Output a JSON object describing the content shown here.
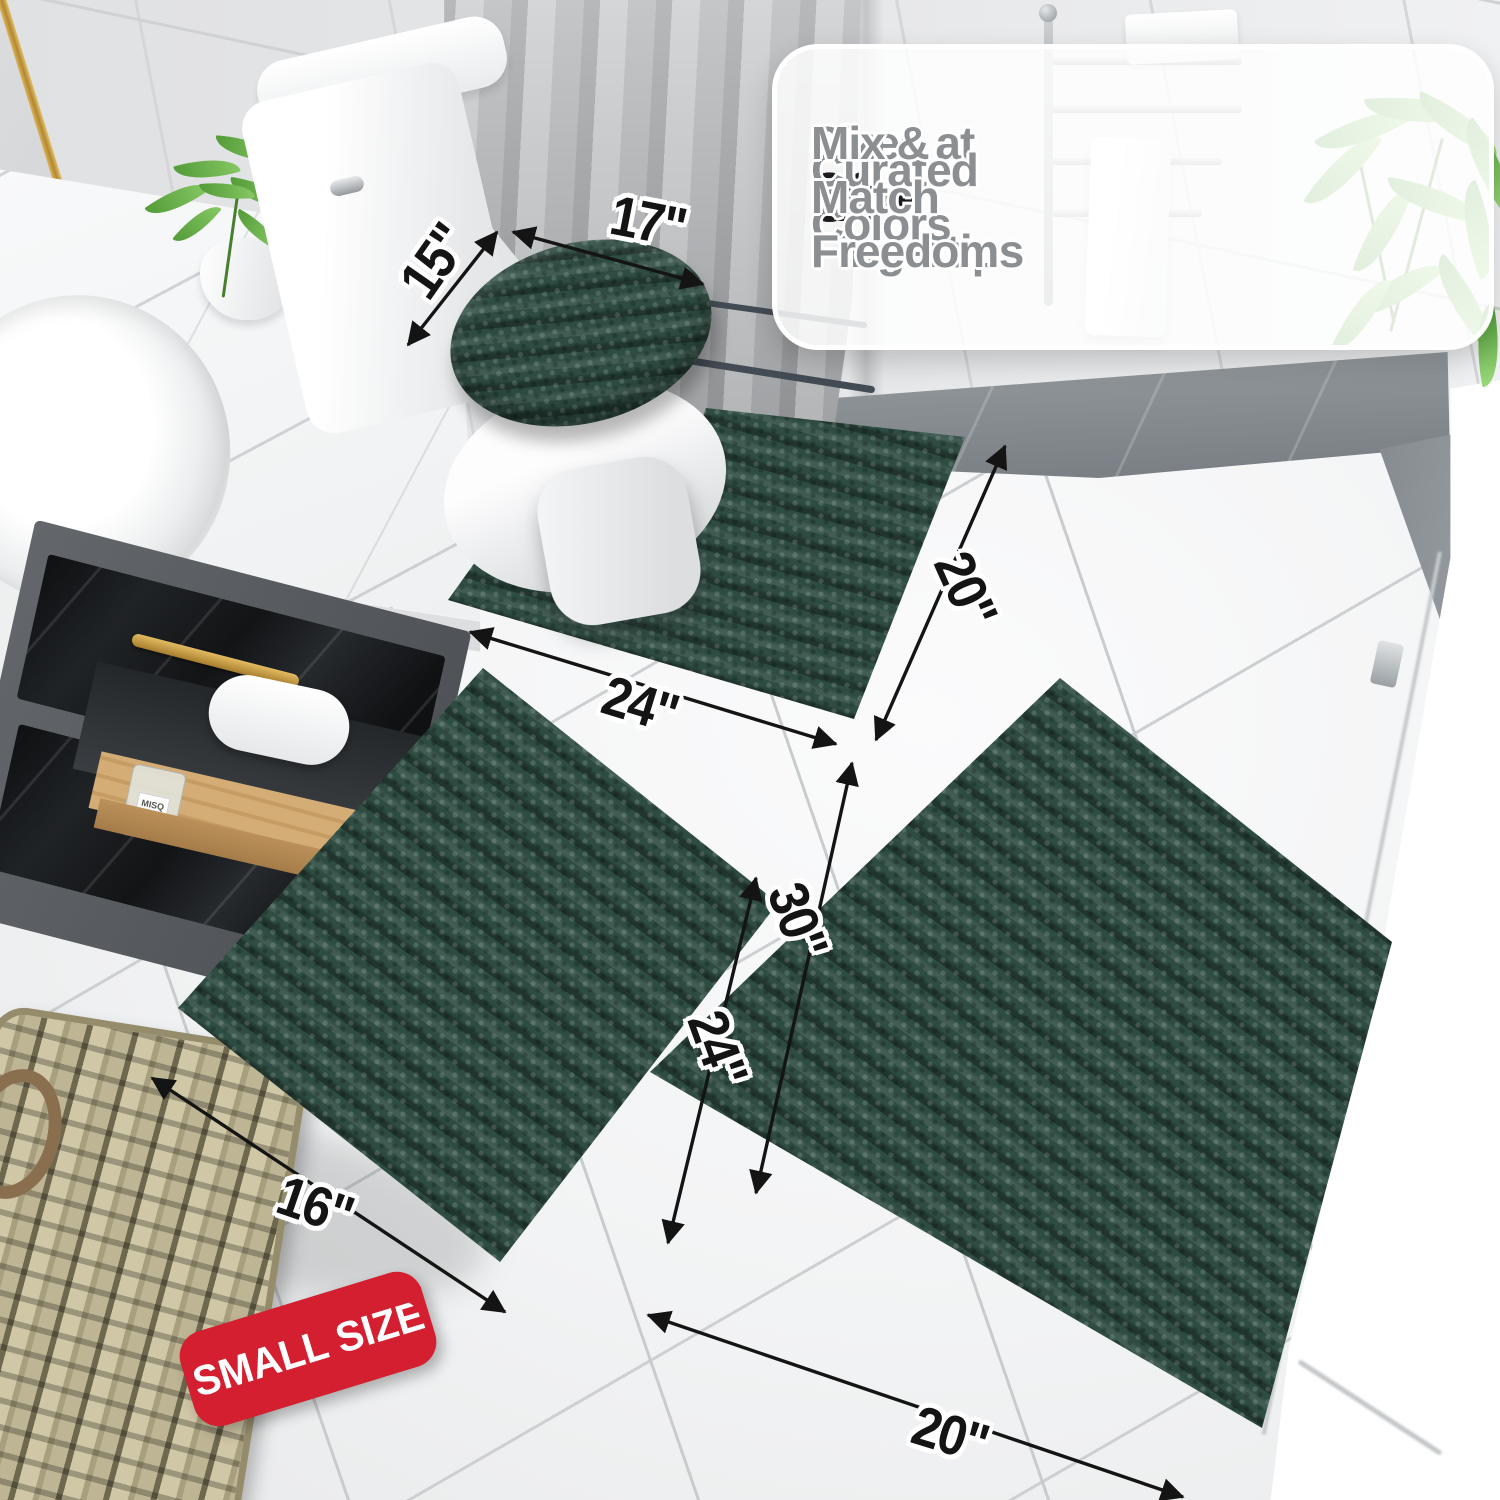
{
  "callout": {
    "items": [
      {
        "icon": "check",
        "stat": "20+",
        "text": "Sizes at Your Fingertips"
      },
      {
        "icon": "check",
        "stat": "30+",
        "text": "Curated Colors"
      },
      {
        "icon": "check",
        "stat": "",
        "text": "Mix & Match Freedom"
      }
    ]
  },
  "measurements": {
    "toilet_lid": {
      "depth": "15\"",
      "width": "17\""
    },
    "contour_rug": {
      "width": "24\"",
      "depth": "20\""
    },
    "small_rug": {
      "width": "16\"",
      "length": "24\""
    },
    "large_rug": {
      "length": "30\"",
      "width": "20\""
    }
  },
  "badge": {
    "label": "SMALL SIZE"
  },
  "decor": {
    "bottle_label": "MISQ"
  },
  "theme": {
    "rug_green": "#2e4c41",
    "rug_green_deep": "#20382f",
    "badge_red": "#d31f2f",
    "check_gray": "#87898c",
    "stat_black": "#1c1c1e",
    "callout_text_gray": "#8c8f92",
    "dim_label_black": "#141414",
    "gold": "#c79a3e"
  }
}
